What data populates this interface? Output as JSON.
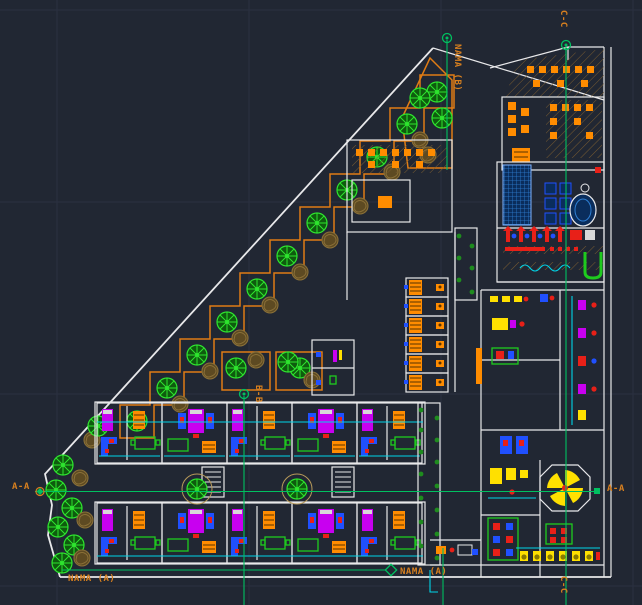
{
  "viewport": {
    "kind": "cad-site-plan"
  },
  "labels": {
    "section_aa_left": "A-A",
    "section_aa_right": "A-A",
    "section_bb": "B-B",
    "section_cc_top": "C-C",
    "section_cc_bottom": "C-C",
    "nama_b_top": "NAMA (B)",
    "nama_a_bottom_left": "NAMA (A)",
    "nama_a_bottom_mid": "NAMA (A)"
  },
  "colors": {
    "bg": "#212733",
    "grid": "#2b3140",
    "wall": "#e8e8ea",
    "section": "#00c060",
    "label": "#d8801f",
    "planter": "#e07c14",
    "tree": "#2ee52e",
    "shrub": "#8a7038",
    "pipe": "#00d4e8",
    "pool": "#2e7fd4",
    "f_magenta": "#c800f0",
    "f_blue": "#2050ff",
    "f_red": "#e82018",
    "f_yellow": "#ffe000",
    "f_green": "#1ecb1e",
    "f_orange": "#ff8c00"
  }
}
